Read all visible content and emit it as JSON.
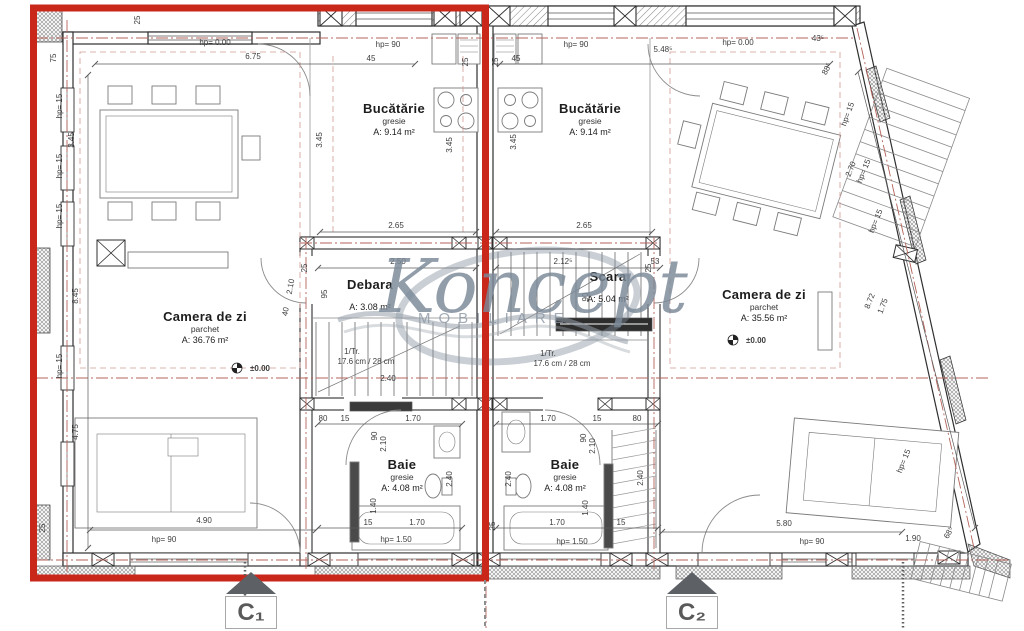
{
  "colors": {
    "highlight": "#c8271a",
    "axis": "#b4635a",
    "wall": "#2f2f2f",
    "watermark": "#7a8897"
  },
  "watermark": {
    "brand": "Koncept",
    "sub": "MOBILIARE"
  },
  "rooms": [
    {
      "name": "Bucătărie",
      "material": "gresie",
      "area": "A: 9.14 m²"
    },
    {
      "name": "Bucătărie",
      "material": "gresie",
      "area": "A: 9.14 m²"
    },
    {
      "name": "Camera de zi",
      "material": "parchet",
      "area": "A: 36.76 m²"
    },
    {
      "name": "Camera de zi",
      "material": "parchet",
      "area": "A: 35.56 m²"
    },
    {
      "name": "Debara",
      "material": "",
      "area": "A: 3.08 m²"
    },
    {
      "name": "Scara",
      "material": "",
      "area": "A: 5.04 m²"
    },
    {
      "name": "Baie",
      "material": "gresie",
      "area": "A: 4.08 m²"
    },
    {
      "name": "Baie",
      "material": "gresie",
      "area": "A: 4.08 m²"
    }
  ],
  "levels": [
    {
      "t": "±0.00",
      "cx": 237,
      "cy": 368,
      "tx": 250,
      "ty": 371
    },
    {
      "t": "±0.00",
      "cx": 733,
      "cy": 340,
      "tx": 746,
      "ty": 343
    }
  ],
  "sections": [
    {
      "label": "C₁"
    },
    {
      "label": "C₂"
    }
  ],
  "dims": [
    {
      "t": "hp= 0.00",
      "x": 215,
      "y": 45
    },
    {
      "t": "6.75",
      "x": 253,
      "y": 59
    },
    {
      "t": "75",
      "x": 56,
      "y": 58,
      "r": -90
    },
    {
      "t": "25",
      "x": 140,
      "y": 20,
      "r": -90
    },
    {
      "t": "hp= 90",
      "x": 388,
      "y": 47
    },
    {
      "t": "45",
      "x": 371,
      "y": 61
    },
    {
      "t": "25",
      "x": 468,
      "y": 62,
      "r": -90
    },
    {
      "t": "25",
      "x": 498,
      "y": 62,
      "r": -90
    },
    {
      "t": "45",
      "x": 516,
      "y": 61
    },
    {
      "t": "hp= 90",
      "x": 576,
      "y": 47
    },
    {
      "t": "5.48⁵",
      "x": 663,
      "y": 52
    },
    {
      "t": "hp= 0.00",
      "x": 738,
      "y": 45
    },
    {
      "t": "43⁵",
      "x": 818,
      "y": 41
    },
    {
      "t": "88⁵",
      "x": 829,
      "y": 70,
      "r": -62
    },
    {
      "t": "hp= 15",
      "x": 850,
      "y": 115,
      "r": -70
    },
    {
      "t": "3.45",
      "x": 74,
      "y": 140,
      "r": -90
    },
    {
      "t": "hp= 15",
      "x": 62,
      "y": 106,
      "r": -90
    },
    {
      "t": "hp= 15",
      "x": 62,
      "y": 166,
      "r": -90
    },
    {
      "t": "hp= 15",
      "x": 62,
      "y": 216,
      "r": -90
    },
    {
      "t": "8.45",
      "x": 78,
      "y": 296,
      "r": -90
    },
    {
      "t": "hp= 15",
      "x": 62,
      "y": 366,
      "r": -90
    },
    {
      "t": "4.75",
      "x": 78,
      "y": 432,
      "r": -90
    },
    {
      "t": "3.45",
      "x": 322,
      "y": 140,
      "r": -90
    },
    {
      "t": "3.45",
      "x": 452,
      "y": 145,
      "r": -90
    },
    {
      "t": "3.45",
      "x": 516,
      "y": 142,
      "r": -90
    },
    {
      "t": "2.65",
      "x": 396,
      "y": 228
    },
    {
      "t": "2.65",
      "x": 584,
      "y": 228
    },
    {
      "t": "2.50",
      "x": 398,
      "y": 264
    },
    {
      "t": "95",
      "x": 327,
      "y": 294,
      "r": -90
    },
    {
      "t": "2.12⁵",
      "x": 563,
      "y": 264
    },
    {
      "t": "53",
      "x": 655,
      "y": 264
    },
    {
      "t": "90",
      "x": 588,
      "y": 297,
      "r": -90
    },
    {
      "t": "2.10",
      "x": 293,
      "y": 287,
      "r": -80
    },
    {
      "t": "40",
      "x": 288,
      "y": 312,
      "r": -80
    },
    {
      "t": "1/Tr.",
      "x": 352,
      "y": 354,
      "s": 7
    },
    {
      "t": "17.6 cm / 28 cm",
      "x": 366,
      "y": 364,
      "s": 7
    },
    {
      "t": "1/Tr.",
      "x": 548,
      "y": 356,
      "s": 7
    },
    {
      "t": "17.6 cm / 28 cm",
      "x": 562,
      "y": 366,
      "s": 7
    },
    {
      "t": "2.40",
      "x": 388,
      "y": 381
    },
    {
      "t": "80",
      "x": 323,
      "y": 421
    },
    {
      "t": "15",
      "x": 345,
      "y": 421
    },
    {
      "t": "1.70",
      "x": 413,
      "y": 421
    },
    {
      "t": "90",
      "x": 377,
      "y": 436,
      "r": -90
    },
    {
      "t": "2.10",
      "x": 386,
      "y": 444,
      "r": -90
    },
    {
      "t": "2.40",
      "x": 452,
      "y": 479,
      "r": -90
    },
    {
      "t": "1.40",
      "x": 376,
      "y": 506,
      "r": -90
    },
    {
      "t": "15",
      "x": 368,
      "y": 525
    },
    {
      "t": "1.70",
      "x": 417,
      "y": 525
    },
    {
      "t": "hp= 1.50",
      "x": 396,
      "y": 542,
      "s": 7.5
    },
    {
      "t": "1.70",
      "x": 548,
      "y": 421
    },
    {
      "t": "15",
      "x": 597,
      "y": 421
    },
    {
      "t": "80",
      "x": 637,
      "y": 421
    },
    {
      "t": "90",
      "x": 586,
      "y": 438,
      "r": -90
    },
    {
      "t": "2.10",
      "x": 595,
      "y": 446,
      "r": -90
    },
    {
      "t": "2.40",
      "x": 511,
      "y": 479,
      "r": -90
    },
    {
      "t": "2.40",
      "x": 643,
      "y": 478,
      "r": -90
    },
    {
      "t": "1.40",
      "x": 588,
      "y": 508,
      "r": -90
    },
    {
      "t": "25",
      "x": 495,
      "y": 526,
      "r": -90
    },
    {
      "t": "1.70",
      "x": 557,
      "y": 525
    },
    {
      "t": "15",
      "x": 621,
      "y": 525
    },
    {
      "t": "hp= 1.50",
      "x": 572,
      "y": 544,
      "s": 7.5
    },
    {
      "t": "4.90",
      "x": 204,
      "y": 523
    },
    {
      "t": "hp= 90",
      "x": 164,
      "y": 542
    },
    {
      "t": "25",
      "x": 45,
      "y": 528,
      "r": -90
    },
    {
      "t": "5.80",
      "x": 784,
      "y": 526
    },
    {
      "t": "hp= 90",
      "x": 812,
      "y": 544
    },
    {
      "t": "1.90",
      "x": 913,
      "y": 541
    },
    {
      "t": "68⁵",
      "x": 951,
      "y": 534,
      "r": -60
    },
    {
      "t": "2.70",
      "x": 853,
      "y": 170,
      "r": -68
    },
    {
      "t": "hp= 15",
      "x": 866,
      "y": 172,
      "r": -68
    },
    {
      "t": "hp= 15",
      "x": 878,
      "y": 222,
      "r": -68
    },
    {
      "t": "8.72",
      "x": 872,
      "y": 302,
      "r": -68
    },
    {
      "t": "1.75",
      "x": 885,
      "y": 307,
      "r": -68
    },
    {
      "t": "hp= 15",
      "x": 906,
      "y": 462,
      "r": -68
    },
    {
      "t": "25",
      "x": 307,
      "y": 268,
      "r": -90
    },
    {
      "t": "25",
      "x": 651,
      "y": 268,
      "r": -90
    }
  ],
  "dimlines": [
    [
      95,
      64,
      415,
      64
    ],
    [
      500,
      64,
      830,
      64
    ],
    [
      320,
      232,
      476,
      232
    ],
    [
      496,
      232,
      652,
      232
    ],
    [
      88,
      75,
      88,
      548
    ],
    [
      90,
      530,
      316,
      530
    ],
    [
      662,
      532,
      902,
      532
    ],
    [
      318,
      268,
      476,
      268
    ],
    [
      496,
      268,
      660,
      268
    ],
    [
      318,
      424,
      462,
      424
    ],
    [
      496,
      424,
      658,
      424
    ],
    [
      318,
      528,
      462,
      528
    ],
    [
      496,
      528,
      658,
      528
    ],
    [
      858,
      72,
      975,
      528
    ]
  ]
}
